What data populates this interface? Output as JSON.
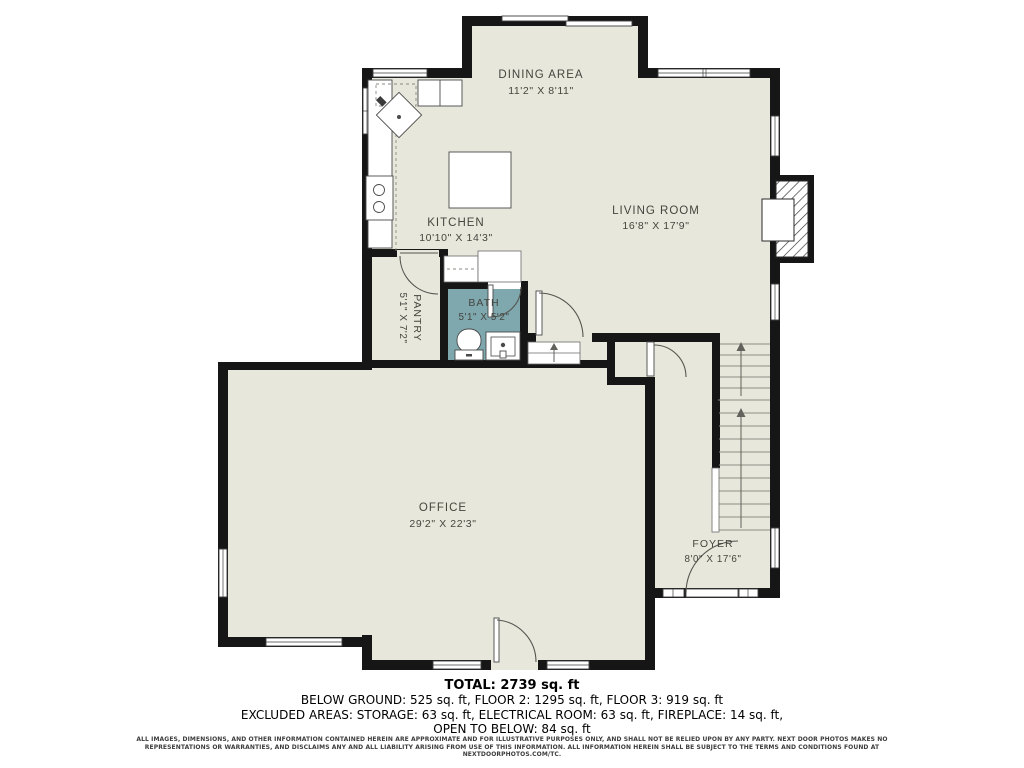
{
  "floor_plan": {
    "colors": {
      "floor": "#e8e7dc",
      "bath_floor": "#7ea7ae",
      "wall": "#161616",
      "label_text": "#45453f",
      "stair_line": "#8e8e84"
    },
    "rooms": {
      "dining": {
        "label": "DINING AREA",
        "dims": "11'2\" X 8'11\""
      },
      "kitchen": {
        "label": "KITCHEN",
        "dims": "10'10\" X 14'3\""
      },
      "living": {
        "label": "LIVING ROOM",
        "dims": "16'8\" X 17'9\""
      },
      "pantry": {
        "label": "PANTRY",
        "dims": "5'1\" X 7'2\""
      },
      "bath": {
        "label": "BATH",
        "dims": "5'1\" X 5'2\""
      },
      "office": {
        "label": "OFFICE",
        "dims": "29'2\" X 22'3\""
      },
      "foyer": {
        "label": "FOYER",
        "dims": "8'0\" X 17'6\""
      }
    },
    "icons": [
      "window",
      "door-swing",
      "sliding-door",
      "stairs-up",
      "fireplace",
      "kitchen-island",
      "sink",
      "stove",
      "toilet",
      "vanity"
    ]
  },
  "summary": {
    "total": "TOTAL: 2739 sq. ft",
    "floors": "BELOW GROUND: 525 sq. ft, FLOOR 2: 1295 sq. ft, FLOOR 3: 919 sq. ft",
    "excluded": "EXCLUDED AREAS: STORAGE: 63 sq. ft, ELECTRICAL ROOM: 63 sq. ft, FIREPLACE: 14 sq. ft,",
    "open_below": "OPEN TO BELOW: 84 sq. ft"
  },
  "disclaimer": {
    "line1": "ALL IMAGES, DIMENSIONS, AND OTHER INFORMATION CONTAINED HEREIN ARE APPROXIMATE AND FOR ILLUSTRATIVE PURPOSES ONLY, AND SHALL NOT BE RELIED UPON BY ANY PARTY.",
    "line2": "NEXT DOOR PHOTOS MAKES NO REPRESENTATIONS OR WARRANTIES, AND DISCLAIMS ANY AND ALL LIABILITY ARISING FROM USE OF THIS INFORMATION. ALL INFORMATION HEREIN",
    "line3": "SHALL BE SUBJECT TO THE TERMS AND CONDITIONS FOUND AT NEXTDOORPHOTOS.COM/TC."
  }
}
